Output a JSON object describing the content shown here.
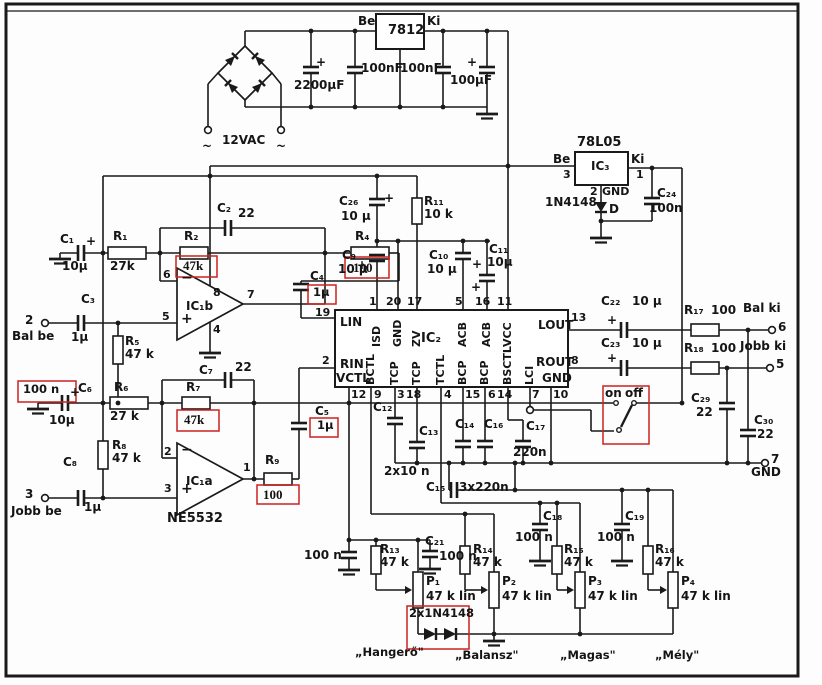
{
  "colors": {
    "ink": "#1a1a1a",
    "annotation_red": "#cc2020",
    "background": "#fdfdfd"
  },
  "labels": {
    "ac_label": "12VAC",
    "ac_t1": "~",
    "ac_t2": "~",
    "reg1": "7812",
    "reg1_in": "Be",
    "reg1_out": "Ki",
    "c_2200": "2200µF",
    "c_100nf_1": "100nF",
    "c_100nf_2": "100nF",
    "c_100uf": "100µF",
    "plus_2200": "+",
    "plus_100uf": "+",
    "reg2_name": "78L05",
    "reg2_ref": "IC₃",
    "reg2_in": "Be",
    "reg2_pin_in": "3",
    "reg2_out": "Ki",
    "reg2_pin_out": "1",
    "reg2_pin_gnd": "2",
    "reg2_gnd": "GND",
    "d1_type": "1N4148",
    "d1_ref": "D",
    "c24_ref": "C₂₄",
    "c24_val": "100n",
    "c1_ref": "C₁",
    "c1_val": "10µ",
    "c1_plus": "+",
    "r1_ref": "R₁",
    "r1_val": "27k",
    "r2_ref": "R₂",
    "rb_r2": "47k",
    "c2_ref": "C₂",
    "c2_val": "22",
    "r4_ref": "R₄",
    "rb_r4": "100",
    "term2_num": "2",
    "term2_label": "Bal be",
    "c3_ref": "C₃",
    "c3_val": "1µ",
    "r5_ref": "R₅",
    "r5_val": "47 k",
    "pin5": "5",
    "pin6": "6",
    "pin7": "7",
    "pin8": "8",
    "pin4o": "4",
    "ic1b": "IC₁b",
    "om1": "−",
    "op1": "+",
    "c4_ref": "C₄",
    "rb_c4": "1µ",
    "c5_ref": "C₅",
    "rb_c5": "1µ",
    "rb_c6": "100 n",
    "c6_ref": "C₆",
    "c6_plus": "+",
    "c6_val": "10µ",
    "r6_ref": "R₆",
    "r6_val": "27 k",
    "r7_ref": "R₇",
    "rb_r7": "47k",
    "c7_ref": "C₇",
    "c7_val": "22",
    "r8_ref": "R₈",
    "r8_val": "47 k",
    "term3_num": "3",
    "term3_label": "Jobb be",
    "c8_ref": "C₈",
    "c8_val": "1µ",
    "pin2o": "2",
    "pin3o": "3",
    "pin1o": "1",
    "ic1a": "IC₁a",
    "ne5532": "NE5532",
    "r9_ref": "R₉",
    "rb_r9": "100",
    "om2": "−",
    "op2": "+",
    "c26_ref": "C₂₆",
    "c26_val": "10 µ",
    "c26_plus": "+",
    "r11_ref": "R₁₁",
    "r11_val": "10 k",
    "c9_ref": "C₉",
    "c9_val": "10 µ",
    "c9_plus": "+",
    "c10_ref": "C₁₀",
    "c10_val": "10 µ",
    "c10_plus": "+",
    "c11_ref": "C₁₁",
    "c11_val": "10µ",
    "c11_plus": "+",
    "ic2_ref": "IC₂",
    "lin": "LIN",
    "rin": "RIN",
    "vctl": "VCTL",
    "lout": "LOUT",
    "rout": "ROUT",
    "gnd_r": "GND",
    "iv_isd": "ISD",
    "iv_gnd20": "GND",
    "iv_zv": "ZV",
    "iv_acb1": "ACB",
    "iv_acb2": "ACB",
    "iv_vcc": "VCC",
    "iv_bctl": "BCTL",
    "iv_tcp1": "TCP",
    "iv_tcp2": "TCP",
    "iv_tctl": "TCTL",
    "iv_bcp1": "BCP",
    "iv_bcp2": "BCP",
    "iv_bsctl": "BSCTL",
    "iv_lci": "LCI",
    "p19": "19",
    "p2": "2",
    "p13": "13",
    "p8": "8",
    "p1t": "1",
    "p20": "20",
    "p17": "17",
    "p5t": "5",
    "p16": "16",
    "p11": "11",
    "p12": "12",
    "p9": "9",
    "p3b": "3",
    "p18": "18",
    "p4b": "4",
    "p15": "15",
    "p6b": "6",
    "p14": "14",
    "p7b": "7",
    "p10": "10",
    "c22_ref": "C₂₂",
    "c22_val": "10 µ",
    "c22_plus": "+",
    "c23_ref": "C₂₃",
    "c23_val": "10 µ",
    "c23_plus": "+",
    "r17_ref": "R₁₇",
    "r17_val": "100",
    "r18_ref": "R₁₈",
    "r18_val": "100",
    "term6_label": "Bal ki",
    "term6_num": "6",
    "term5_label": "Jobb ki",
    "term5_num": "5",
    "c29_ref": "C₂₉",
    "c29_val": "22",
    "c30_ref": "C₃₀",
    "c30_val": "22",
    "term7_num": "7",
    "term7_label": "GND",
    "sw_on": "on",
    "sw_off": "off",
    "c12_ref": "C₁₂",
    "c13_ref": "C₁₃",
    "c1213_val": "2x10 n",
    "c14_ref": "C₁₄",
    "c16_ref": "C₁₆",
    "c15_ref": "C₁₅",
    "c141516_val": "3x220n",
    "c17_ref": "C₁₇",
    "c17_val": "220n",
    "c18_ref": "C₁₈",
    "c18_val": "100 n",
    "c19_ref": "C₁₉",
    "c19_val": "100 n",
    "c20_val": "100 n",
    "c21_ref": "C₂₁",
    "c21_val": "100 n",
    "r13_ref": "R₁₃",
    "r13_val": "47 k",
    "r14_ref": "R₁₄",
    "r14_val": "47 k",
    "r15_ref": "R₁₅",
    "r15_val": "47 k",
    "r16_ref": "R₁₆",
    "r16_val": "47 k",
    "p1_ref": "P₁",
    "p1_val": "47 k lin",
    "p2_ref": "P₂",
    "p2_val": "47 k lin",
    "p3_ref": "P₃",
    "p3_val": "47 k lin",
    "p4_ref": "P₄",
    "p4_val": "47 k lin",
    "d_pair": "2x1N4148",
    "cap_vol": "„Hangerő\"",
    "cap_bal": "„Balansz\"",
    "cap_tre": "„Magas\"",
    "cap_bass": "„Mély\""
  }
}
